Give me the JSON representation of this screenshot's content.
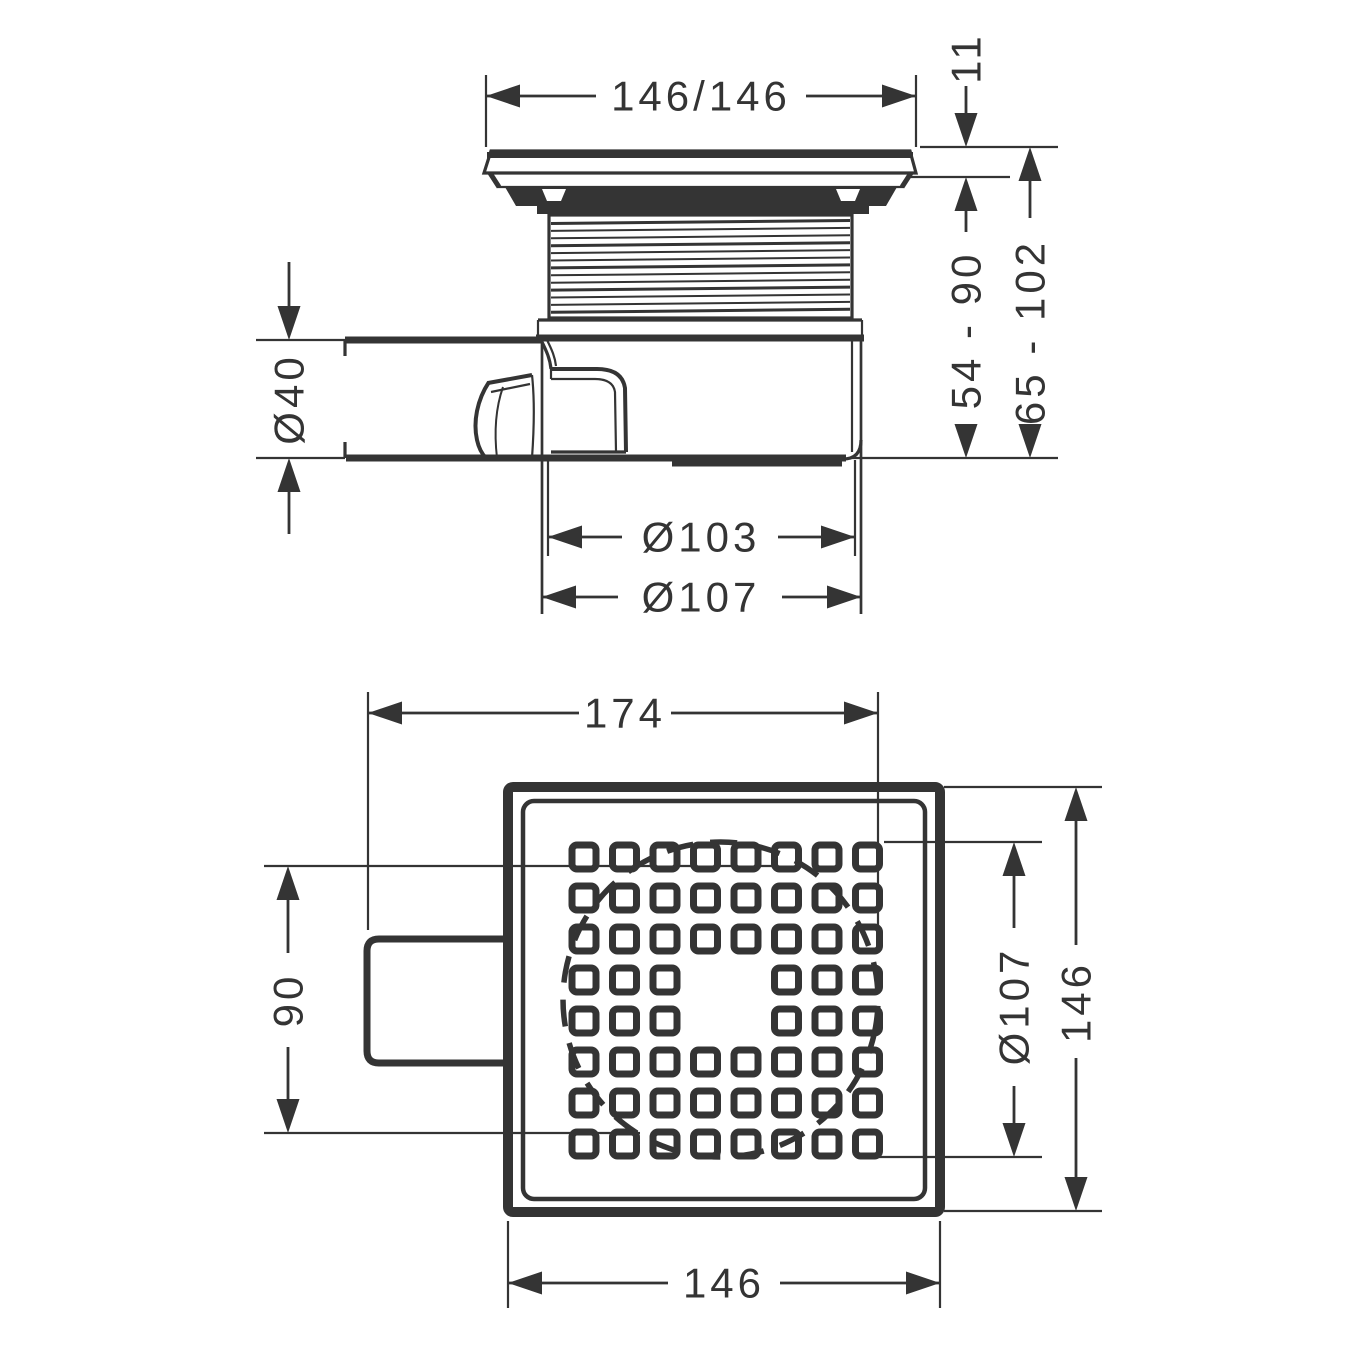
{
  "colors": {
    "ink": "#343434",
    "paper": "#ffffff"
  },
  "side_view": {
    "dims": {
      "overall_width": "146/146",
      "cover_height": "11",
      "frame_height_range": "54 - 90",
      "total_height_range": "65 - 102",
      "outlet_diameter": "Ø40",
      "flange_diameter": "Ø103",
      "body_diameter": "Ø107"
    }
  },
  "plan_view": {
    "dims": {
      "overall_length": "174",
      "outlet_span": "90",
      "body_circle_diameter": "Ø107",
      "side_length_right": "146",
      "side_length_bottom": "146"
    },
    "grate": {
      "rows": 8,
      "cols": 8,
      "missing_rows": [
        4,
        5
      ],
      "missing_cols": [
        4,
        5
      ]
    }
  }
}
